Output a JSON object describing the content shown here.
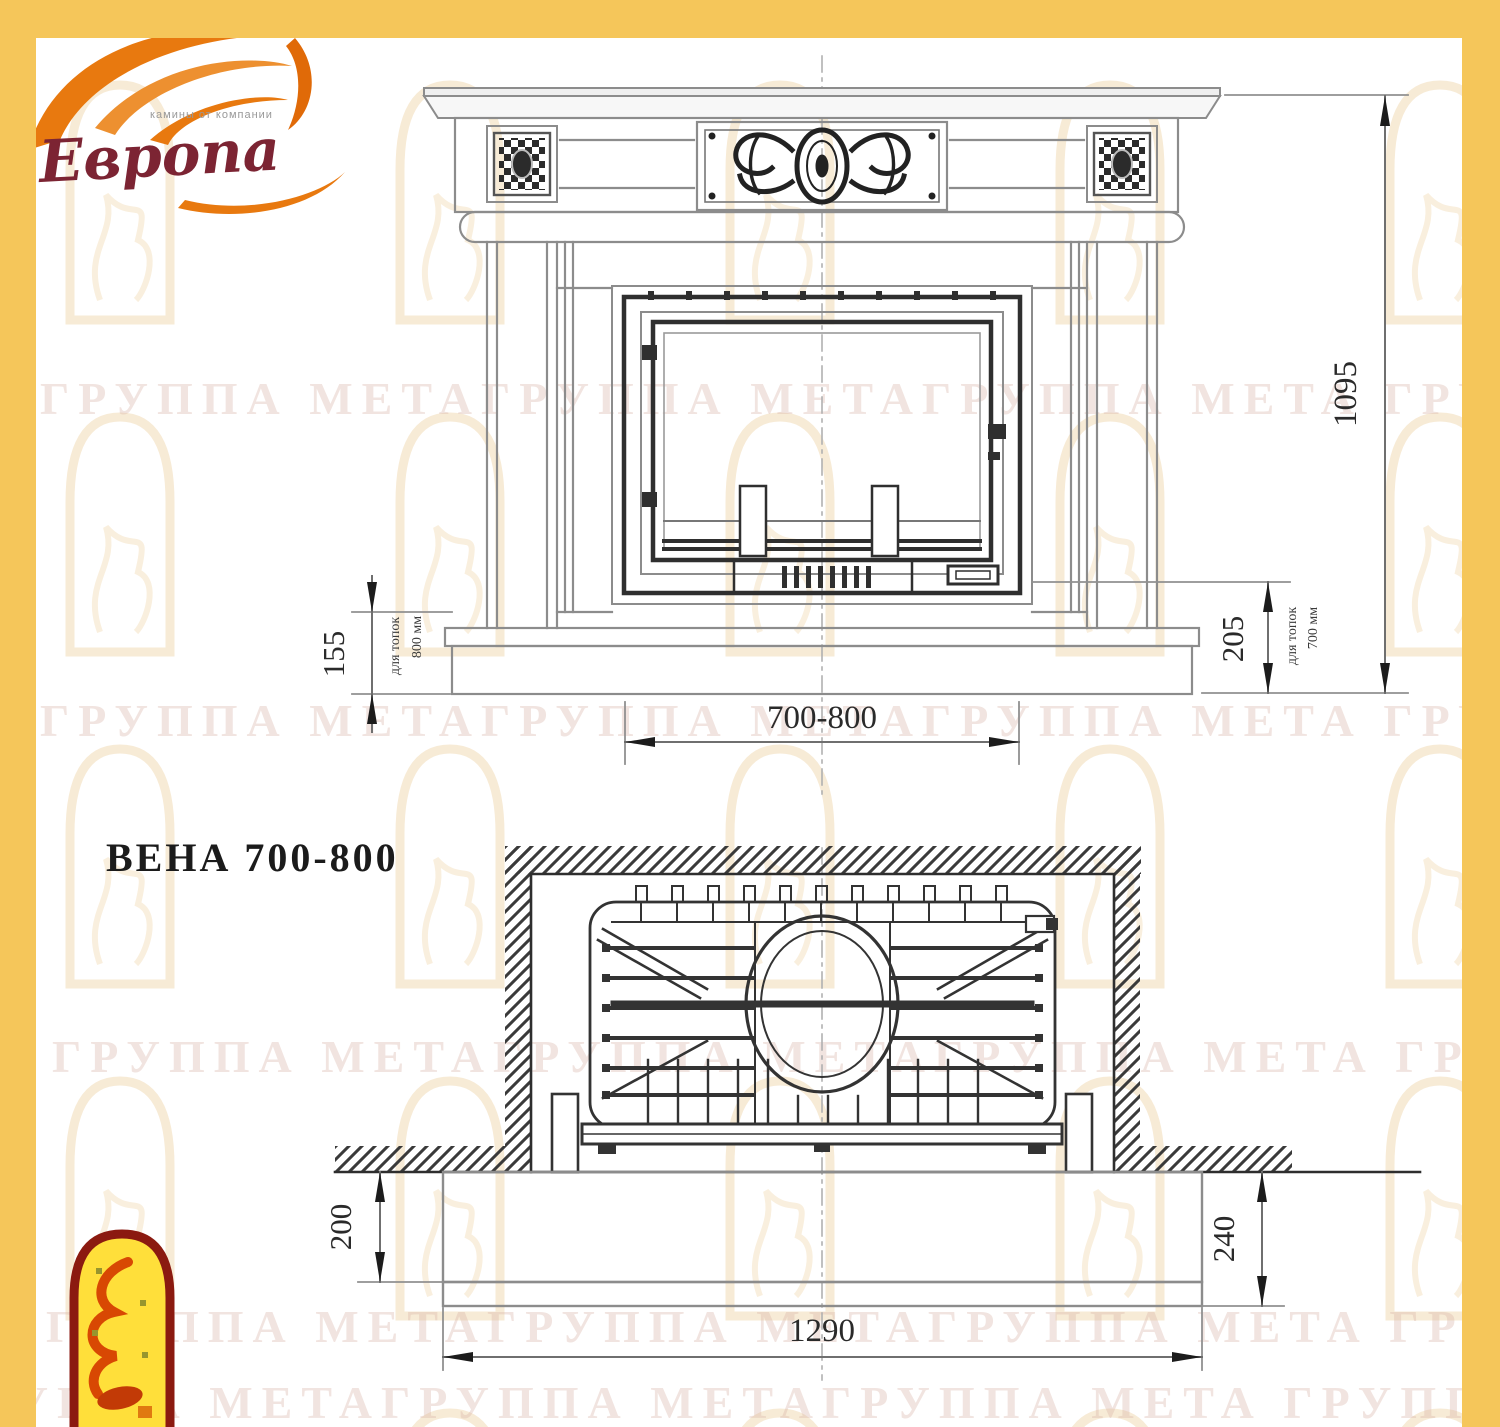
{
  "page": {
    "frame_color": "#f5c65a",
    "background": "#ffffff"
  },
  "brand_logo": {
    "name": "Европа",
    "tagline": "камины от компании"
  },
  "meta_logo": {
    "name": "arch-flame-emblem"
  },
  "title": "ВЕНА 700-800",
  "watermark": {
    "text": "ГРУППА МЕТАГРУППА МЕТАГРУППА МЕТА ГРУППА"
  },
  "front_view": {
    "dims": {
      "height": "1095",
      "left": "155",
      "left_note": {
        "label": "для топок",
        "value": "800 мм"
      },
      "right": "205",
      "right_note": {
        "label": "для топок",
        "value": "700 мм"
      },
      "opening": "700-800"
    }
  },
  "plan_view": {
    "dims": {
      "left": "200",
      "right": "240",
      "width": "1290"
    }
  },
  "colors": {
    "frame_yellow": "#f5c65a",
    "outline_gray": "#8c8c8c",
    "dark_line": "#2f2f2f",
    "dim_text": "#2a2a2a",
    "watermark": "#d8b2a6",
    "brand_red": "#7c2433",
    "flame_orange": "#e8790f",
    "emblem_yellow": "#ffdf3a",
    "emblem_border": "#8b1a10"
  }
}
